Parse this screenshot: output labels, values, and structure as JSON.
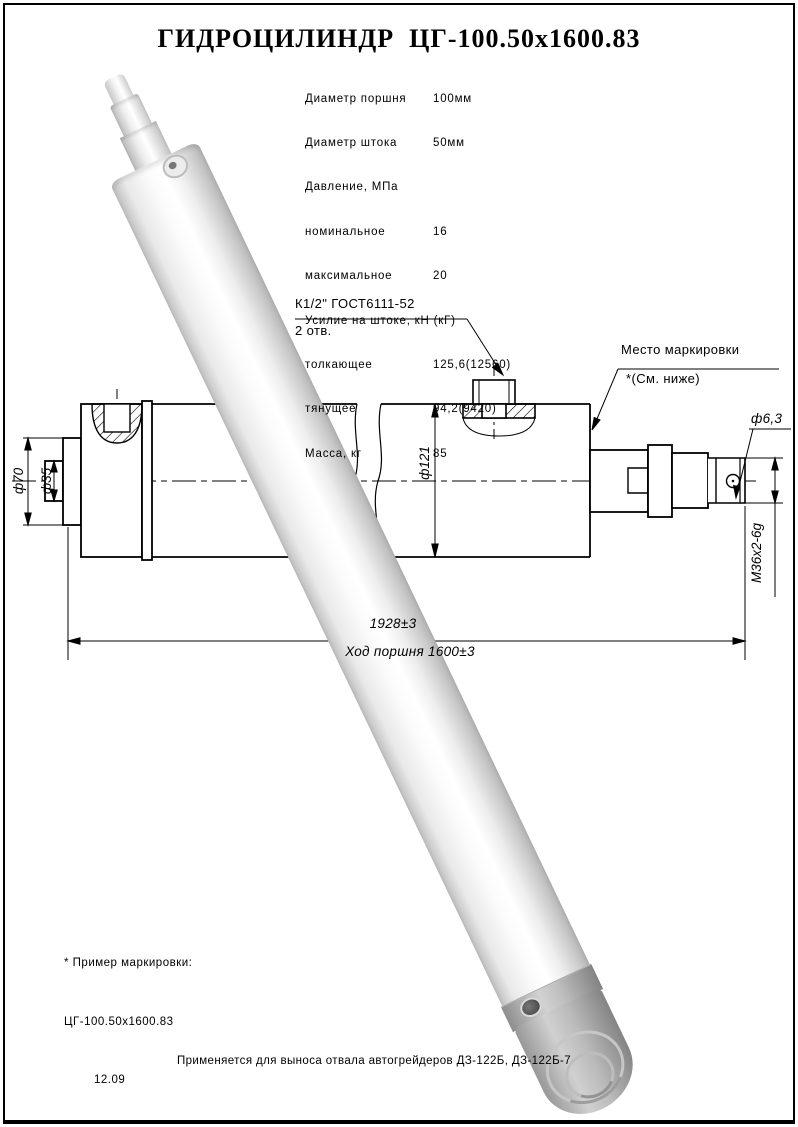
{
  "title": "ГИДРОЦИЛИНДР  ЦГ-100.50х1600.83",
  "specs": {
    "rows": [
      {
        "label": "Диаметр поршня",
        "value": "100мм"
      },
      {
        "label": "Диаметр штока",
        "value": "50мм"
      },
      {
        "label": "Давление, МПа",
        "value": ""
      },
      {
        "label": "номинальное",
        "value": "16"
      },
      {
        "label": "максимальное",
        "value": "20"
      },
      {
        "label": "Усилие на штоке, кН (кГ)",
        "value": ""
      },
      {
        "label": "толкающее",
        "value": "125,6(12560)"
      },
      {
        "label": "тянущее",
        "value": "94,2(9420)"
      },
      {
        "label": "Масса, кг",
        "value": "85"
      }
    ]
  },
  "callouts": {
    "port": {
      "line1": "К1/2\" ГОСТ6111-52",
      "line2": "2 отв."
    },
    "marking": {
      "line1": "Место маркировки",
      "line2": "*(См. ниже)"
    }
  },
  "dimensions": {
    "rod_collar": "ф70",
    "rod": "ф35",
    "bore": "ф121",
    "hole": "ф6,3",
    "thread": "М36х2-6g",
    "overall": "1928±3",
    "stroke": "Ход поршня 1600±3"
  },
  "notes": {
    "line1": "* Пример маркировки:",
    "line2": "ЦГ-100.50х1600.83",
    "line3": "12.09"
  },
  "footer": "Применяется для выноса отвала автогрейдеров ДЗ-122Б, ДЗ-122Б-7",
  "colors": {
    "line": "#000000",
    "paper": "#ffffff",
    "render_gray": "#c9c9c9"
  }
}
